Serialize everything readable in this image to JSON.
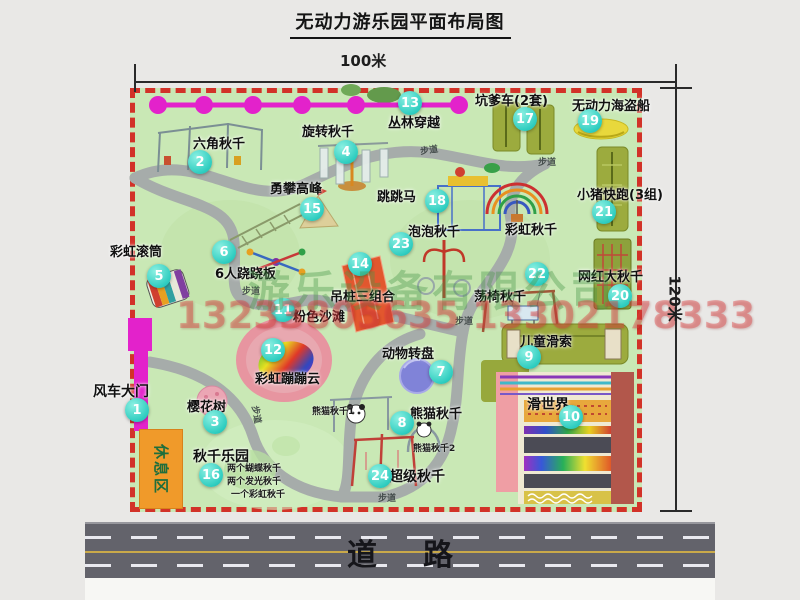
{
  "title": "无动力游乐园平面布局图",
  "dimensions": {
    "width_label": "100米",
    "height_label": "120米"
  },
  "road": {
    "label": "道路"
  },
  "watermark": {
    "company": "游乐设备有限公司",
    "phone": "13233805635 13302178333"
  },
  "markers": [
    {
      "num": "1",
      "label": "风车大门"
    },
    {
      "num": "2",
      "label": "六角秋千"
    },
    {
      "num": "3",
      "label": "樱花树"
    },
    {
      "num": "4",
      "label": "旋转秋千"
    },
    {
      "num": "5",
      "label": "彩虹滚筒"
    },
    {
      "num": "6",
      "label": "6人跷跷板"
    },
    {
      "num": "7",
      "label": "动物转盘"
    },
    {
      "num": "8",
      "label": "熊猫秋千"
    },
    {
      "num": "9",
      "label": "儿童滑索"
    },
    {
      "num": "10",
      "label": "滑世界"
    },
    {
      "num": "11",
      "label": "粉色沙滩"
    },
    {
      "num": "12",
      "label": "彩虹蹦蹦云"
    },
    {
      "num": "13",
      "label": "丛林穿越"
    },
    {
      "num": "14",
      "label": "吊桩三组合"
    },
    {
      "num": "15",
      "label": "勇攀高峰"
    },
    {
      "num": "16",
      "label": "秋千乐园"
    },
    {
      "num": "17",
      "label": "坑爹车(2套)"
    },
    {
      "num": "18",
      "label": "跳跳马"
    },
    {
      "num": "19",
      "label": "无动力海盗船"
    },
    {
      "num": "20",
      "label": "网红大秋千"
    },
    {
      "num": "21",
      "label": "小猪快跑(3组)"
    },
    {
      "num": "22",
      "label": "荡椅秋千"
    },
    {
      "num": "23",
      "label": "泡泡秋千"
    },
    {
      "num": "24",
      "label": "超级秋千"
    }
  ],
  "annotations": {
    "rainbow_swing": "彩虹秋千",
    "rest_area": "休息区",
    "footpath": "步道",
    "panda_swing_1": "熊猫秋千1",
    "panda_swing_2": "熊猫秋千2",
    "swing_park_details": [
      "两个蝴蝶秋千",
      "两个发光秋千",
      "一个彩虹秋千"
    ]
  },
  "colors": {
    "map_green": "#c9e8b5",
    "border_red": "#d23228",
    "zipline_magenta": "#e322cb",
    "marker_teal": "#2fcdc0",
    "rest_area_orange": "#f09a2a",
    "road_gray": "#63636b"
  }
}
